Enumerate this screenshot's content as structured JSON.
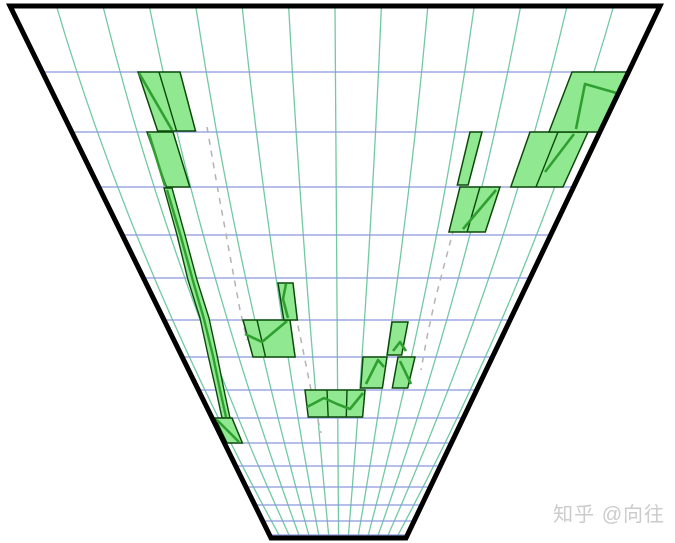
{
  "watermark": {
    "text": "知乎 @向往"
  },
  "colors": {
    "background": "#ffffff",
    "outline": "#000000",
    "vertical_grid": "#72c9a3",
    "horizontal_grid": "#8a99dc",
    "candle_fill": "#90e890",
    "candle_stroke": "#0a4a0a",
    "price_line": "#2fa02f",
    "dashed_line": "#b3b3b3",
    "watermark": "#cbcbcb"
  },
  "funnel": {
    "top_left": [
      10,
      6
    ],
    "top_right": [
      660,
      6
    ],
    "bottom_right": [
      406,
      538
    ],
    "bottom_left": [
      271,
      538
    ],
    "stroke_width": 5
  },
  "projection": {
    "vanishing_point": [
      339.5,
      677.5
    ],
    "bow_factor": 0.06
  },
  "grid": {
    "horizontal_lines_y": [
      72,
      132,
      187,
      235,
      278,
      320,
      357,
      390,
      418,
      443,
      466,
      487,
      505,
      521,
      535
    ],
    "vertical_lines_top_x": [
      56.4,
      102.9,
      149.3,
      195.7,
      242.1,
      288.6,
      335,
      381.4,
      427.9,
      474.3,
      520.7,
      567.1,
      613.6
    ]
  },
  "dashed_lines": [
    [
      [
        207,
        127
      ],
      [
        217,
        185
      ],
      [
        228,
        245
      ],
      [
        240,
        310
      ],
      [
        247,
        340
      ]
    ],
    [
      [
        293,
        302
      ],
      [
        302,
        345
      ],
      [
        311,
        390
      ],
      [
        321,
        433
      ]
    ],
    [
      [
        460,
        205
      ],
      [
        445,
        262
      ],
      [
        435,
        300
      ],
      [
        427,
        337
      ],
      [
        421,
        370
      ]
    ]
  ],
  "sliver": {
    "polygon": [
      [
        164,
        188
      ],
      [
        172,
        188
      ],
      [
        185,
        235
      ],
      [
        197,
        280
      ],
      [
        209,
        318
      ],
      [
        217,
        355
      ],
      [
        224,
        390
      ],
      [
        230,
        418
      ],
      [
        222,
        418
      ],
      [
        216,
        390
      ],
      [
        208,
        355
      ],
      [
        200,
        318
      ],
      [
        188,
        280
      ],
      [
        177,
        235
      ]
    ],
    "price_line": [
      [
        167,
        190
      ],
      [
        181,
        237
      ],
      [
        193,
        281
      ],
      [
        204,
        319
      ],
      [
        213,
        356
      ],
      [
        220,
        390
      ],
      [
        226,
        417
      ]
    ]
  },
  "candles": [
    {
      "x1": 138,
      "x2": 180,
      "y1": 72,
      "y2": 131,
      "div": [
        159
      ],
      "line": [
        [
          139,
          73
        ],
        [
          172,
          130
        ]
      ]
    },
    {
      "x1": 147,
      "x2": 173,
      "y1": 132,
      "y2": 187,
      "div": [],
      "line": [
        [
          149,
          134
        ],
        [
          165,
          186
        ]
      ]
    },
    {
      "x1": 215,
      "x2": 232,
      "y1": 418,
      "y2": 443,
      "div": [],
      "line": [
        [
          217,
          420
        ],
        [
          239,
          442
        ]
      ]
    },
    {
      "x1": 243,
      "x2": 290,
      "y1": 320,
      "y2": 357,
      "div": [
        257
      ],
      "line": [
        [
          245,
          334
        ],
        [
          262,
          342
        ],
        [
          287,
          321
        ]
      ]
    },
    {
      "x1": 278,
      "x2": 293,
      "y1": 283,
      "y2": 320,
      "div": [],
      "line": [
        [
          288,
          318
        ],
        [
          283,
          299
        ],
        [
          286,
          284
        ]
      ]
    },
    {
      "x1": 305,
      "x2": 365,
      "y1": 390,
      "y2": 417,
      "div": [
        327,
        347
      ],
      "line": [
        [
          307,
          407
        ],
        [
          324,
          398
        ],
        [
          337,
          404
        ],
        [
          350,
          409
        ],
        [
          363,
          393
        ]
      ]
    },
    {
      "x1": 363,
      "x2": 387,
      "y1": 357,
      "y2": 388,
      "div": [],
      "line": [
        [
          366,
          384
        ],
        [
          378,
          360
        ],
        [
          384,
          367
        ]
      ]
    },
    {
      "x1": 398,
      "x2": 415,
      "y1": 357,
      "y2": 388,
      "div": [],
      "line": [
        [
          400,
          361
        ],
        [
          411,
          384
        ]
      ]
    },
    {
      "x1": 392,
      "x2": 408,
      "y1": 322,
      "y2": 355,
      "div": [],
      "line": [
        [
          393,
          351
        ],
        [
          400,
          342
        ],
        [
          406,
          351
        ]
      ]
    },
    {
      "x1": 460,
      "x2": 500,
      "y1": 187,
      "y2": 232,
      "div": [
        480
      ],
      "line": [
        [
          463,
          229
        ],
        [
          496,
          190
        ]
      ]
    },
    {
      "x1": 470,
      "x2": 482,
      "y1": 132,
      "y2": 185,
      "div": [],
      "line": []
    },
    {
      "x1": 530,
      "x2": 588,
      "y1": 132,
      "y2": 187,
      "div": [
        558
      ],
      "line": [
        [
          545,
          172
        ],
        [
          574,
          134
        ]
      ]
    },
    {
      "x1": 572,
      "x2": 629,
      "y1": 72,
      "y2": 132,
      "div": [],
      "line": [
        [
          576,
          129
        ],
        [
          585,
          84
        ],
        [
          627,
          96
        ]
      ]
    }
  ],
  "chart_data": {
    "type": "candlestick",
    "title": "",
    "xlabel": "",
    "ylabel": "",
    "note": "Candlestick chart mapped onto a one-point-perspective funnel; uniform world grid of 14 columns x 15 rows, no axis tick labels visible in image",
    "columns": 14,
    "rows": 15,
    "grid": "on",
    "bodies": [
      {
        "col": 3,
        "row_top": 1,
        "row_bottom": 2
      },
      {
        "col": 3,
        "row_top": 2,
        "row_bottom": 3
      },
      {
        "col": 4,
        "row_top": 3,
        "row_bottom": 9,
        "style": "thin"
      },
      {
        "col": 5,
        "row_top": 9,
        "row_bottom": 10
      },
      {
        "col": "5-6",
        "row_top": 6,
        "row_bottom": 7
      },
      {
        "col": 6,
        "row_top": 5,
        "row_bottom": 6,
        "style": "thin"
      },
      {
        "col": "7-8",
        "row_top": 8,
        "row_bottom": 9
      },
      {
        "col": 8,
        "row_top": 7,
        "row_bottom": 8
      },
      {
        "col": 9,
        "row_top": 7,
        "row_bottom": 8
      },
      {
        "col": 9,
        "row_top": 6,
        "row_bottom": 7
      },
      {
        "col": 10,
        "row_top": 3,
        "row_bottom": 4
      },
      {
        "col": 10,
        "row_top": 2,
        "row_bottom": 3,
        "style": "thin"
      },
      {
        "col": "11-12",
        "row_top": 2,
        "row_bottom": 3
      },
      {
        "col": 13,
        "row_top": 1,
        "row_bottom": 2
      }
    ],
    "dashed_trendlines": 3,
    "legend_position": "none"
  }
}
